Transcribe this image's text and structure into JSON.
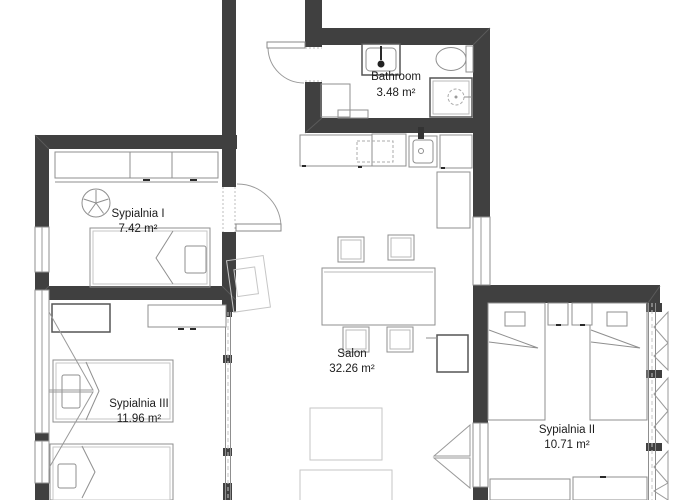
{
  "floor_plan": {
    "rooms": [
      {
        "id": "bathroom",
        "name": "Bathroom",
        "area": "3.48 m²"
      },
      {
        "id": "sypialnia-1",
        "name": "Sypialnia I",
        "area": "7.42 m²"
      },
      {
        "id": "salon",
        "name": "Salon",
        "area": "32.26 m²"
      },
      {
        "id": "sypialnia-3",
        "name": "Sypialnia III",
        "area": "11.96 m²"
      },
      {
        "id": "sypialnia-2",
        "name": "Sypialnia II",
        "area": "10.71 m²"
      }
    ],
    "colors": {
      "wall": "#404040",
      "furniture_line": "#8f8f8f",
      "light_furniture_line": "#c6c6c6",
      "text": "#1c1c1c",
      "background": "#ffffff"
    }
  }
}
